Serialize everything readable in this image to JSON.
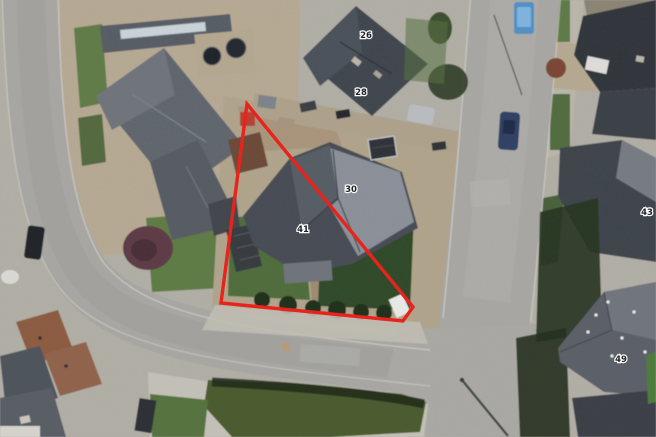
{
  "boundary": {
    "color": "#e8231b",
    "points": "247,104 221,303 403,321 413,307"
  },
  "house_numbers": {
    "n26": "26",
    "n28": "28",
    "n30": "30",
    "n41": "41",
    "n43": "43",
    "n49": "49"
  }
}
